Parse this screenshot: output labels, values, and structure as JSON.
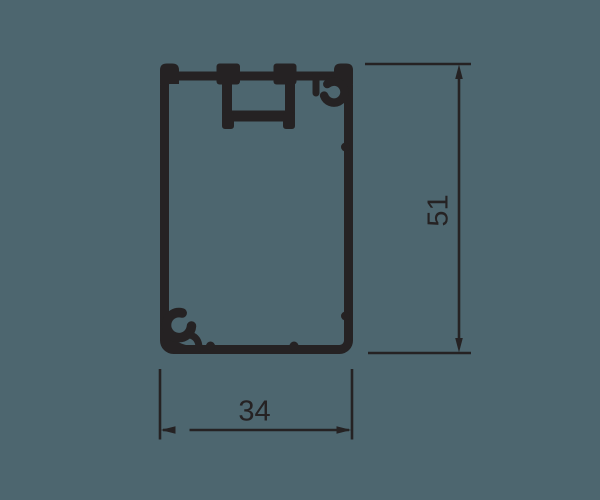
{
  "page": {
    "background_color": "#4d666f",
    "ink_color": "#252223"
  },
  "drawing": {
    "kind": "extrusion-profile-cross-section",
    "dimensions": {
      "height": {
        "value": "51",
        "orientation": "vertical"
      },
      "width": {
        "value": "34",
        "orientation": "horizontal"
      }
    }
  }
}
